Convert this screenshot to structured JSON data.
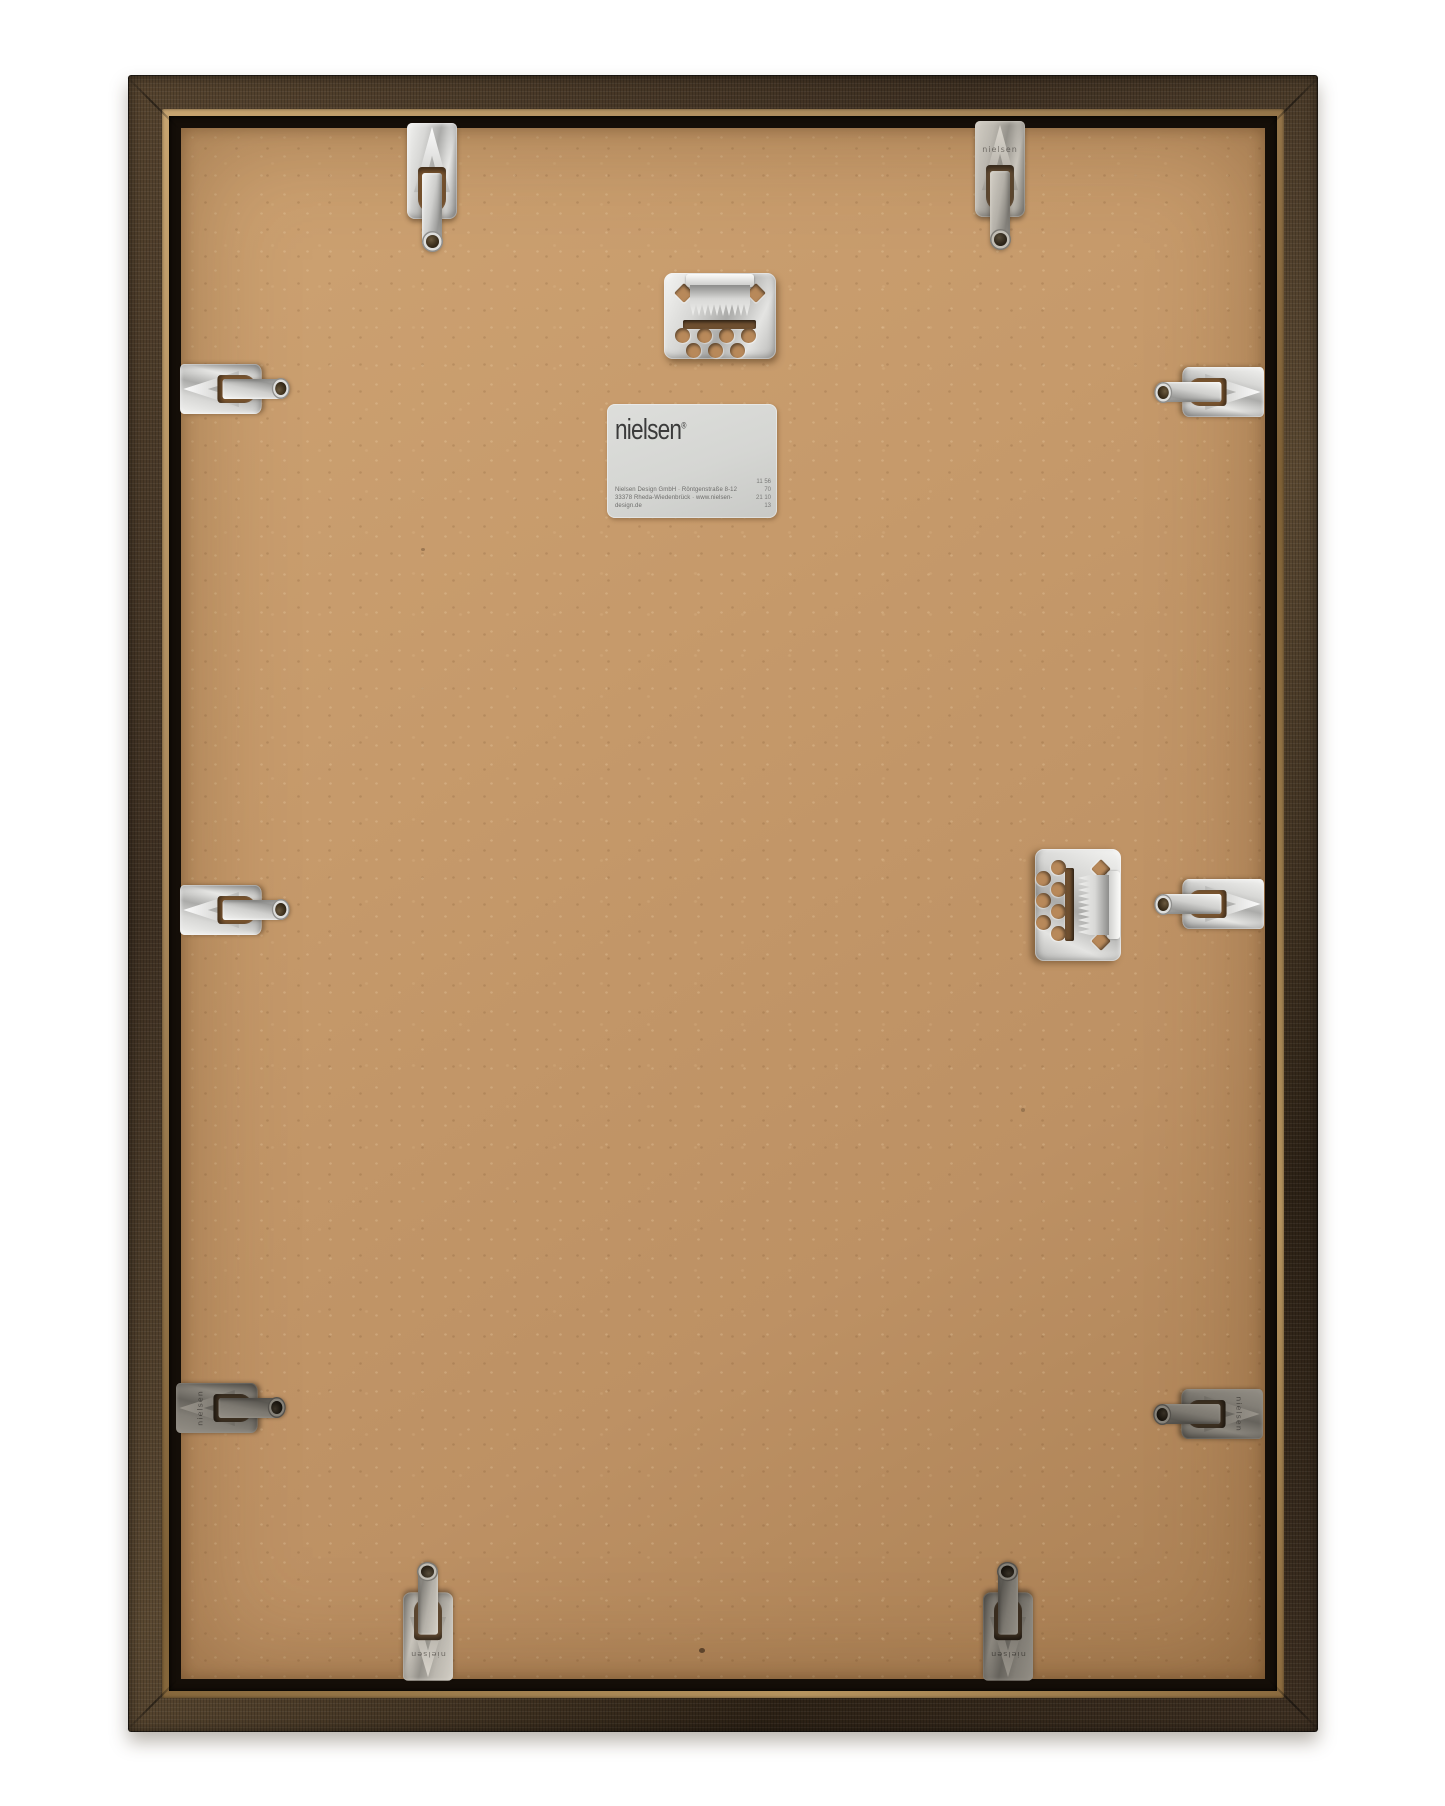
{
  "scene": {
    "subject": "Back of a nielsen picture frame"
  },
  "label": {
    "brand": "nielsen",
    "trademark": "®",
    "address_line1": "Nielsen Design GmbH · Röntgenstraße 8-12",
    "address_line2": "33378 Rheda-Wiedenbrück · www.nielsen-design.de",
    "code_top": "11 56 70",
    "code_bottom": "21 10 13"
  },
  "hardware": {
    "clip_stamp": "nielsen",
    "spring_clip_count": 10,
    "sawtooth_hanger_count": 2
  },
  "colors": {
    "background": "#ffffff",
    "frame_dark": "#3d2f21",
    "frame_mid": "#55432e",
    "frame_lip": "#a9885b",
    "rebate_shadow": "#140e08",
    "board": "#c69a6b",
    "board_shadow": "#8a6036",
    "metal_light": "#f2f2f0",
    "metal_mid": "#ababa9",
    "label_bg": "#d5d6d3",
    "label_text": "#3b3b3b"
  }
}
